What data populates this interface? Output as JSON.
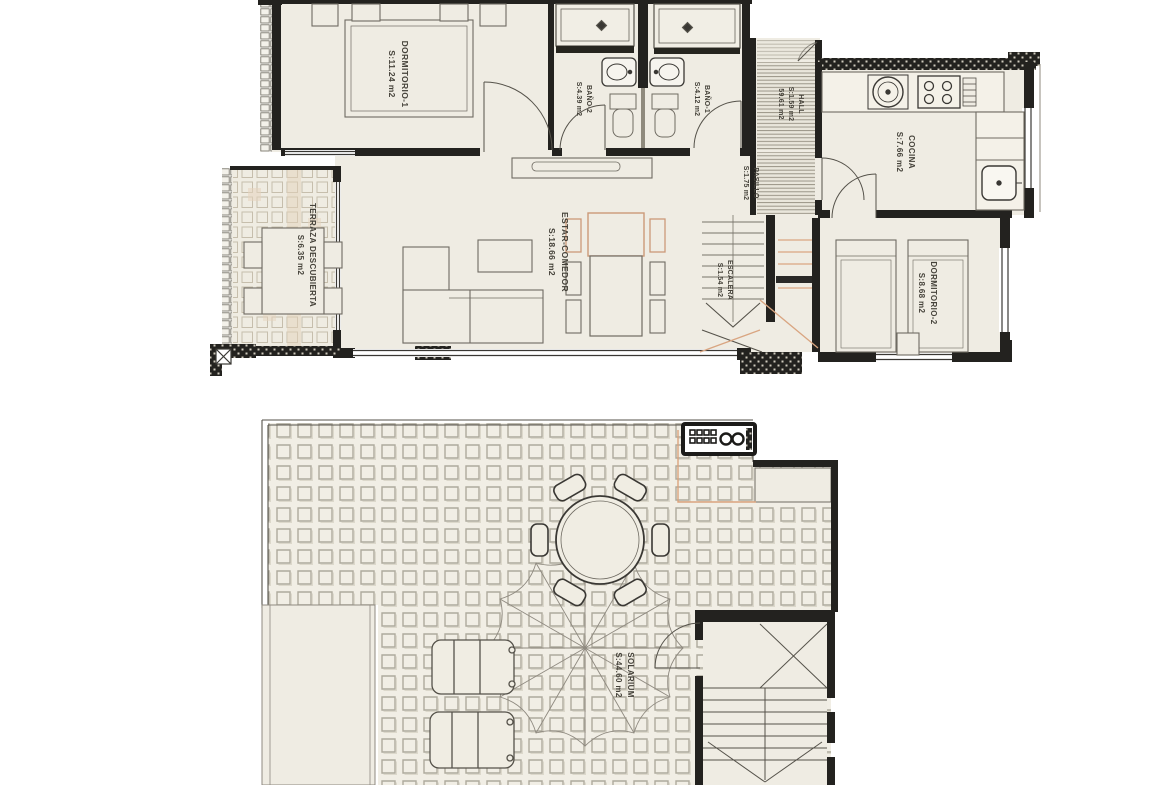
{
  "document": {
    "type": "floor-plan-drawing",
    "language": "es",
    "units": "m2"
  },
  "colors": {
    "paper": "#ffffff",
    "plan_fill": "#efece3",
    "wall": "#23221f",
    "line_gray": "#6f6b62",
    "tile_gray": "#b0ab9e",
    "accent_orange": "#d9a581"
  },
  "floor_main": {
    "rooms": {
      "dormitorio1": {
        "name": "DORMITORIO-1",
        "area": "S:11.24 m2"
      },
      "bano2": {
        "name": "BAÑO-2",
        "area": "S:4.39 m2"
      },
      "bano1": {
        "name": "BAÑO-1",
        "area": "S:4.12 m2"
      },
      "hall": {
        "name": "HALL",
        "area": "S:1.59 m2",
        "total": "59.61 m2"
      },
      "cocina": {
        "name": "COCINA",
        "area": "S:7.66 m2"
      },
      "pasillo": {
        "name": "PASILLO",
        "area": "S:1.75 m2"
      },
      "escalera": {
        "name": "ESCALERA",
        "area": "S:1.54 m2"
      },
      "estar": {
        "name": "ESTAR-COMEDOR",
        "area": "S:18.66 m2"
      },
      "terraza": {
        "name": "TERRAZA DESCUBIERTA",
        "area": "S:6.35 m2"
      },
      "dormitorio2": {
        "name": "DORMITORIO-2",
        "area": "S:8.68 m2"
      }
    }
  },
  "floor_roof": {
    "rooms": {
      "solarium": {
        "name": "SOLARIUM",
        "area": "S:44.60 m2"
      }
    }
  }
}
